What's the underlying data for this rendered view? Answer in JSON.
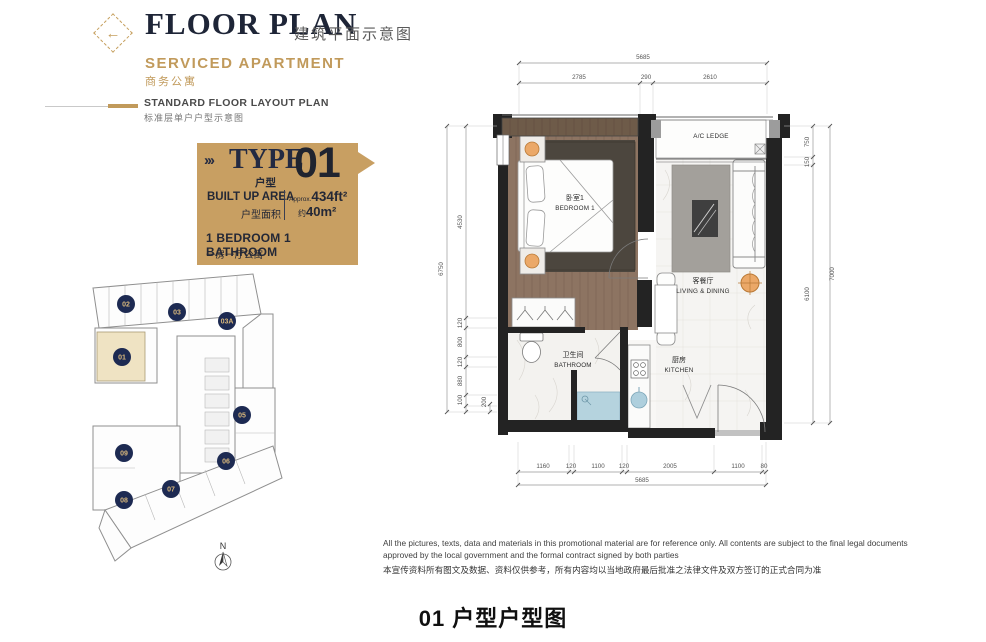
{
  "header": {
    "title": "FLOOR PLAN",
    "title_cn": "建筑平面示意图",
    "subtitle": "SERVICED APARTMENT",
    "subtitle_cn": "商务公寓",
    "section_title": "STANDARD FLOOR LAYOUT PLAN",
    "section_title_cn": "标准层单户户型示意图"
  },
  "type_card": {
    "chevrons": "›››",
    "type_label": "TYPE",
    "type_label_cn": "户型",
    "unit_number": "01",
    "built_up_label": "BUILT UP AREA",
    "built_up_label_cn": "户型面积",
    "area_approx_prefix": "Approx.",
    "area_imperial": "434ft²",
    "area_metric_prefix": "约",
    "area_metric": "40m²",
    "layout_desc": "1 BEDROOM 1 BATHROOM",
    "layout_desc_cn": "一房一厅公寓"
  },
  "key_plan": {
    "highlighted_unit": "01",
    "north_label": "N",
    "units": [
      {
        "label": "02"
      },
      {
        "label": "03"
      },
      {
        "label": "03A"
      },
      {
        "label": "01"
      },
      {
        "label": "05"
      },
      {
        "label": "09"
      },
      {
        "label": "06"
      },
      {
        "label": "07"
      },
      {
        "label": "08"
      }
    ]
  },
  "floor_plan": {
    "rooms": {
      "bedroom_cn": "卧室1",
      "bedroom_en": "BEDROOM 1",
      "living_cn": "客餐厅",
      "living_en": "LIVING & DINING",
      "bathroom_cn": "卫生间",
      "bathroom_en": "BATHROOM",
      "kitchen_cn": "厨房",
      "kitchen_en": "KITCHEN",
      "ac_ledge": "A/C LEDGE"
    },
    "dimensions": {
      "top_total": "5685",
      "top_segments": [
        "2785",
        "290",
        "2610"
      ],
      "left_total": "6750",
      "left_segments": [
        "4530",
        "120",
        "800",
        "120",
        "880",
        "100"
      ],
      "left_extra": "200",
      "right_total": "7000",
      "right_segments": [
        "750",
        "150",
        "6100"
      ],
      "bottom_total": "5685",
      "bottom_segments": [
        "1160",
        "120",
        "1100",
        "120",
        "2005",
        "1100",
        "80"
      ]
    }
  },
  "disclaimer": {
    "en": "All the pictures, texts, data and materials in this promotional material are for reference only. All contents are subject to the final legal documents approved by the local government and the formal contract signed by both parties",
    "cn": "本宣传资料所有图文及数据、资料仅供参考，所有内容均以当地政府最后批准之法律文件及双方签订的正式合同为准"
  },
  "caption": "01 户型户型图",
  "colors": {
    "gold": "#C19A5B",
    "navy": "#20273B",
    "card_gold": "#C89F62",
    "highlight_beige": "#EFE3C3",
    "wood": "#8D7462",
    "rug_dark": "#4C463E",
    "rug_gray": "#A3A09B",
    "water_blue": "#B5D3DE",
    "lamp_orange": "#EBA868"
  }
}
